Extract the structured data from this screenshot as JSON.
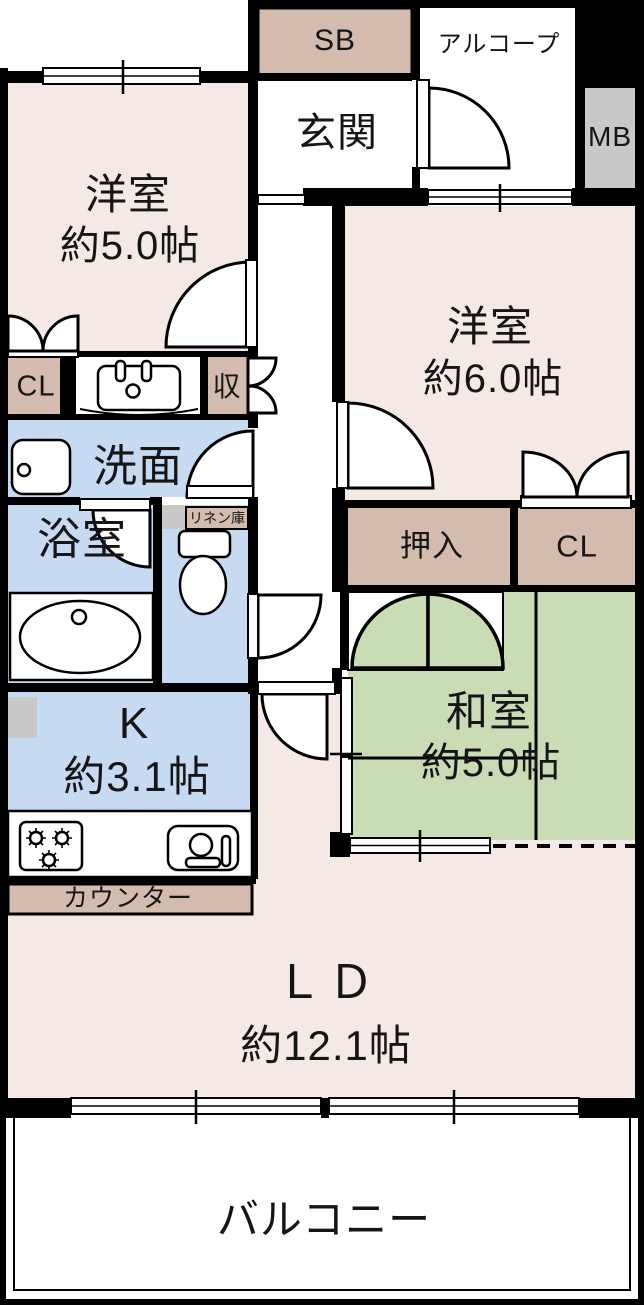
{
  "title": "間取り図",
  "colors": {
    "west": "#f4e9e4",
    "tatami": "#c9dcb5",
    "wet": "#c6dbf1",
    "storage": "#d3bcad",
    "gray": "#c8c8c8",
    "wall": "#000000",
    "bg": "#ffffff"
  },
  "labels": {
    "sb": "SB",
    "alcove": "アルコープ",
    "mb": "MB",
    "genkan": "玄関",
    "room5_name": "洋室",
    "room5_size": "約5.0帖",
    "room6_name": "洋室",
    "room6_size": "約6.0帖",
    "washitsu_name": "和室",
    "washitsu_size": "約5.0帖",
    "ld_name": "ＬＤ",
    "ld_size": "約12.1帖",
    "k_name": "K",
    "k_size": "約3.1帖",
    "senmen": "洗面",
    "bath": "浴室",
    "linen": "リネン庫",
    "oshiire": "押入",
    "cl_main": "CL",
    "cl_sub": "CL",
    "shuno": "収",
    "counter": "カウンター",
    "balcony": "バルコニー"
  }
}
